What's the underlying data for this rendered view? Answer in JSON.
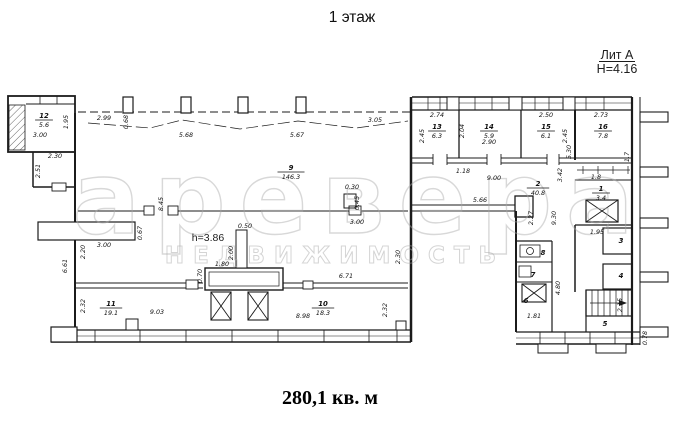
{
  "header": {
    "title": "1 этаж"
  },
  "legend": {
    "liter": "Лит А",
    "height": "H=4.16"
  },
  "footer": {
    "total_area": "280,1 кв. м"
  },
  "watermark": {
    "line1": "аревера",
    "line2": "НЕДВИЖИМОСТЬ"
  },
  "colors": {
    "ink": "#1b1b1b",
    "watermark": "#a9a9a9",
    "paper": "#ffffff"
  },
  "plan": {
    "height_note": "h=3.86",
    "rooms": [
      {
        "n": "12",
        "a": "5.6",
        "x": 44,
        "y": 118
      },
      {
        "n": "9",
        "a": "146.3",
        "x": 291,
        "y": 170
      },
      {
        "n": "2",
        "a": "40.8",
        "x": 538,
        "y": 186
      },
      {
        "n": "13",
        "a": "6.3",
        "x": 437,
        "y": 129
      },
      {
        "n": "14",
        "a": "5.9",
        "x": 489,
        "y": 129
      },
      {
        "n": "15",
        "a": "6.1",
        "x": 546,
        "y": 129
      },
      {
        "n": "16",
        "a": "7.8",
        "x": 603,
        "y": 129
      },
      {
        "n": "1",
        "a": "3.4",
        "x": 601,
        "y": 191
      },
      {
        "n": "11",
        "a": "19.1",
        "x": 111,
        "y": 306
      },
      {
        "n": "10",
        "a": "18.3",
        "x": 323,
        "y": 306
      }
    ],
    "plain_rooms": [
      {
        "n": "3",
        "x": 621,
        "y": 243
      },
      {
        "n": "4",
        "x": 621,
        "y": 278
      },
      {
        "n": "5",
        "x": 605,
        "y": 326
      },
      {
        "n": "6",
        "x": 526,
        "y": 303
      },
      {
        "n": "7",
        "x": 533,
        "y": 277
      },
      {
        "n": "8",
        "x": 543,
        "y": 255
      }
    ],
    "dims": [
      {
        "t": "1.95",
        "x": 68,
        "y": 122,
        "r": 90
      },
      {
        "t": "3.00",
        "x": 40,
        "y": 137,
        "r": 0
      },
      {
        "t": "2.99",
        "x": 104,
        "y": 120,
        "r": 0
      },
      {
        "t": "0.68",
        "x": 128,
        "y": 122,
        "r": 90
      },
      {
        "t": "5.68",
        "x": 186,
        "y": 137,
        "r": 0
      },
      {
        "t": "5.67",
        "x": 297,
        "y": 137,
        "r": 0
      },
      {
        "t": "3.05",
        "x": 375,
        "y": 122,
        "r": 0
      },
      {
        "t": "2.30",
        "x": 55,
        "y": 158,
        "r": 0
      },
      {
        "t": "2.51",
        "x": 40,
        "y": 171,
        "r": 90
      },
      {
        "t": "2.74",
        "x": 437,
        "y": 117,
        "r": 0
      },
      {
        "t": "2.45",
        "x": 424,
        "y": 136,
        "r": 90
      },
      {
        "t": "2.04",
        "x": 464,
        "y": 131,
        "r": 90
      },
      {
        "t": "2.90",
        "x": 489,
        "y": 144,
        "r": 0
      },
      {
        "t": "2.50",
        "x": 546,
        "y": 117,
        "r": 0
      },
      {
        "t": "2.45",
        "x": 567,
        "y": 136,
        "r": 90
      },
      {
        "t": "2.73",
        "x": 601,
        "y": 117,
        "r": 0
      },
      {
        "t": "1.18",
        "x": 463,
        "y": 173,
        "r": 0
      },
      {
        "t": "9.00",
        "x": 494,
        "y": 180,
        "r": 0
      },
      {
        "t": "5.30",
        "x": 571,
        "y": 152,
        "r": 90
      },
      {
        "t": "1.8",
        "x": 596,
        "y": 179,
        "r": 0
      },
      {
        "t": "1.7",
        "x": 629,
        "y": 157,
        "r": 90
      },
      {
        "t": "0.30",
        "x": 352,
        "y": 189,
        "r": 0
      },
      {
        "t": "0.45",
        "x": 359,
        "y": 203,
        "r": 90
      },
      {
        "t": "3.42",
        "x": 562,
        "y": 175,
        "r": 90
      },
      {
        "t": "9.30",
        "x": 556,
        "y": 218,
        "r": 90
      },
      {
        "t": "2.27",
        "x": 533,
        "y": 218,
        "r": 90
      },
      {
        "t": "5.66",
        "x": 480,
        "y": 202,
        "r": 0
      },
      {
        "t": "1.95",
        "x": 597,
        "y": 234,
        "r": 0
      },
      {
        "t": "3.00",
        "x": 357,
        "y": 224,
        "r": 0
      },
      {
        "t": "2.30",
        "x": 400,
        "y": 257,
        "r": 90
      },
      {
        "t": "8.45",
        "x": 163,
        "y": 204,
        "r": 90
      },
      {
        "t": "0.50",
        "x": 245,
        "y": 228,
        "r": 0
      },
      {
        "t": "2.00",
        "x": 233,
        "y": 253,
        "r": 90
      },
      {
        "t": "1.80",
        "x": 222,
        "y": 266,
        "r": 0
      },
      {
        "t": "0.70",
        "x": 202,
        "y": 276,
        "r": 90
      },
      {
        "t": "0.67",
        "x": 142,
        "y": 233,
        "r": 90
      },
      {
        "t": "3.00",
        "x": 104,
        "y": 247,
        "r": 0
      },
      {
        "t": "2.20",
        "x": 85,
        "y": 252,
        "r": 90
      },
      {
        "t": "6.61",
        "x": 67,
        "y": 266,
        "r": 90
      },
      {
        "t": "2.32",
        "x": 85,
        "y": 306,
        "r": 90
      },
      {
        "t": "9.03",
        "x": 157,
        "y": 314,
        "r": 0
      },
      {
        "t": "6.71",
        "x": 346,
        "y": 278,
        "r": 0
      },
      {
        "t": "8.98",
        "x": 303,
        "y": 318,
        "r": 0
      },
      {
        "t": "2.32",
        "x": 387,
        "y": 310,
        "r": 90
      },
      {
        "t": "4.80",
        "x": 560,
        "y": 288,
        "r": 90
      },
      {
        "t": "1.81",
        "x": 534,
        "y": 318,
        "r": 0
      },
      {
        "t": "2.15",
        "x": 622,
        "y": 305,
        "r": 90
      },
      {
        "t": "0.78",
        "x": 647,
        "y": 338,
        "r": 90
      }
    ]
  }
}
